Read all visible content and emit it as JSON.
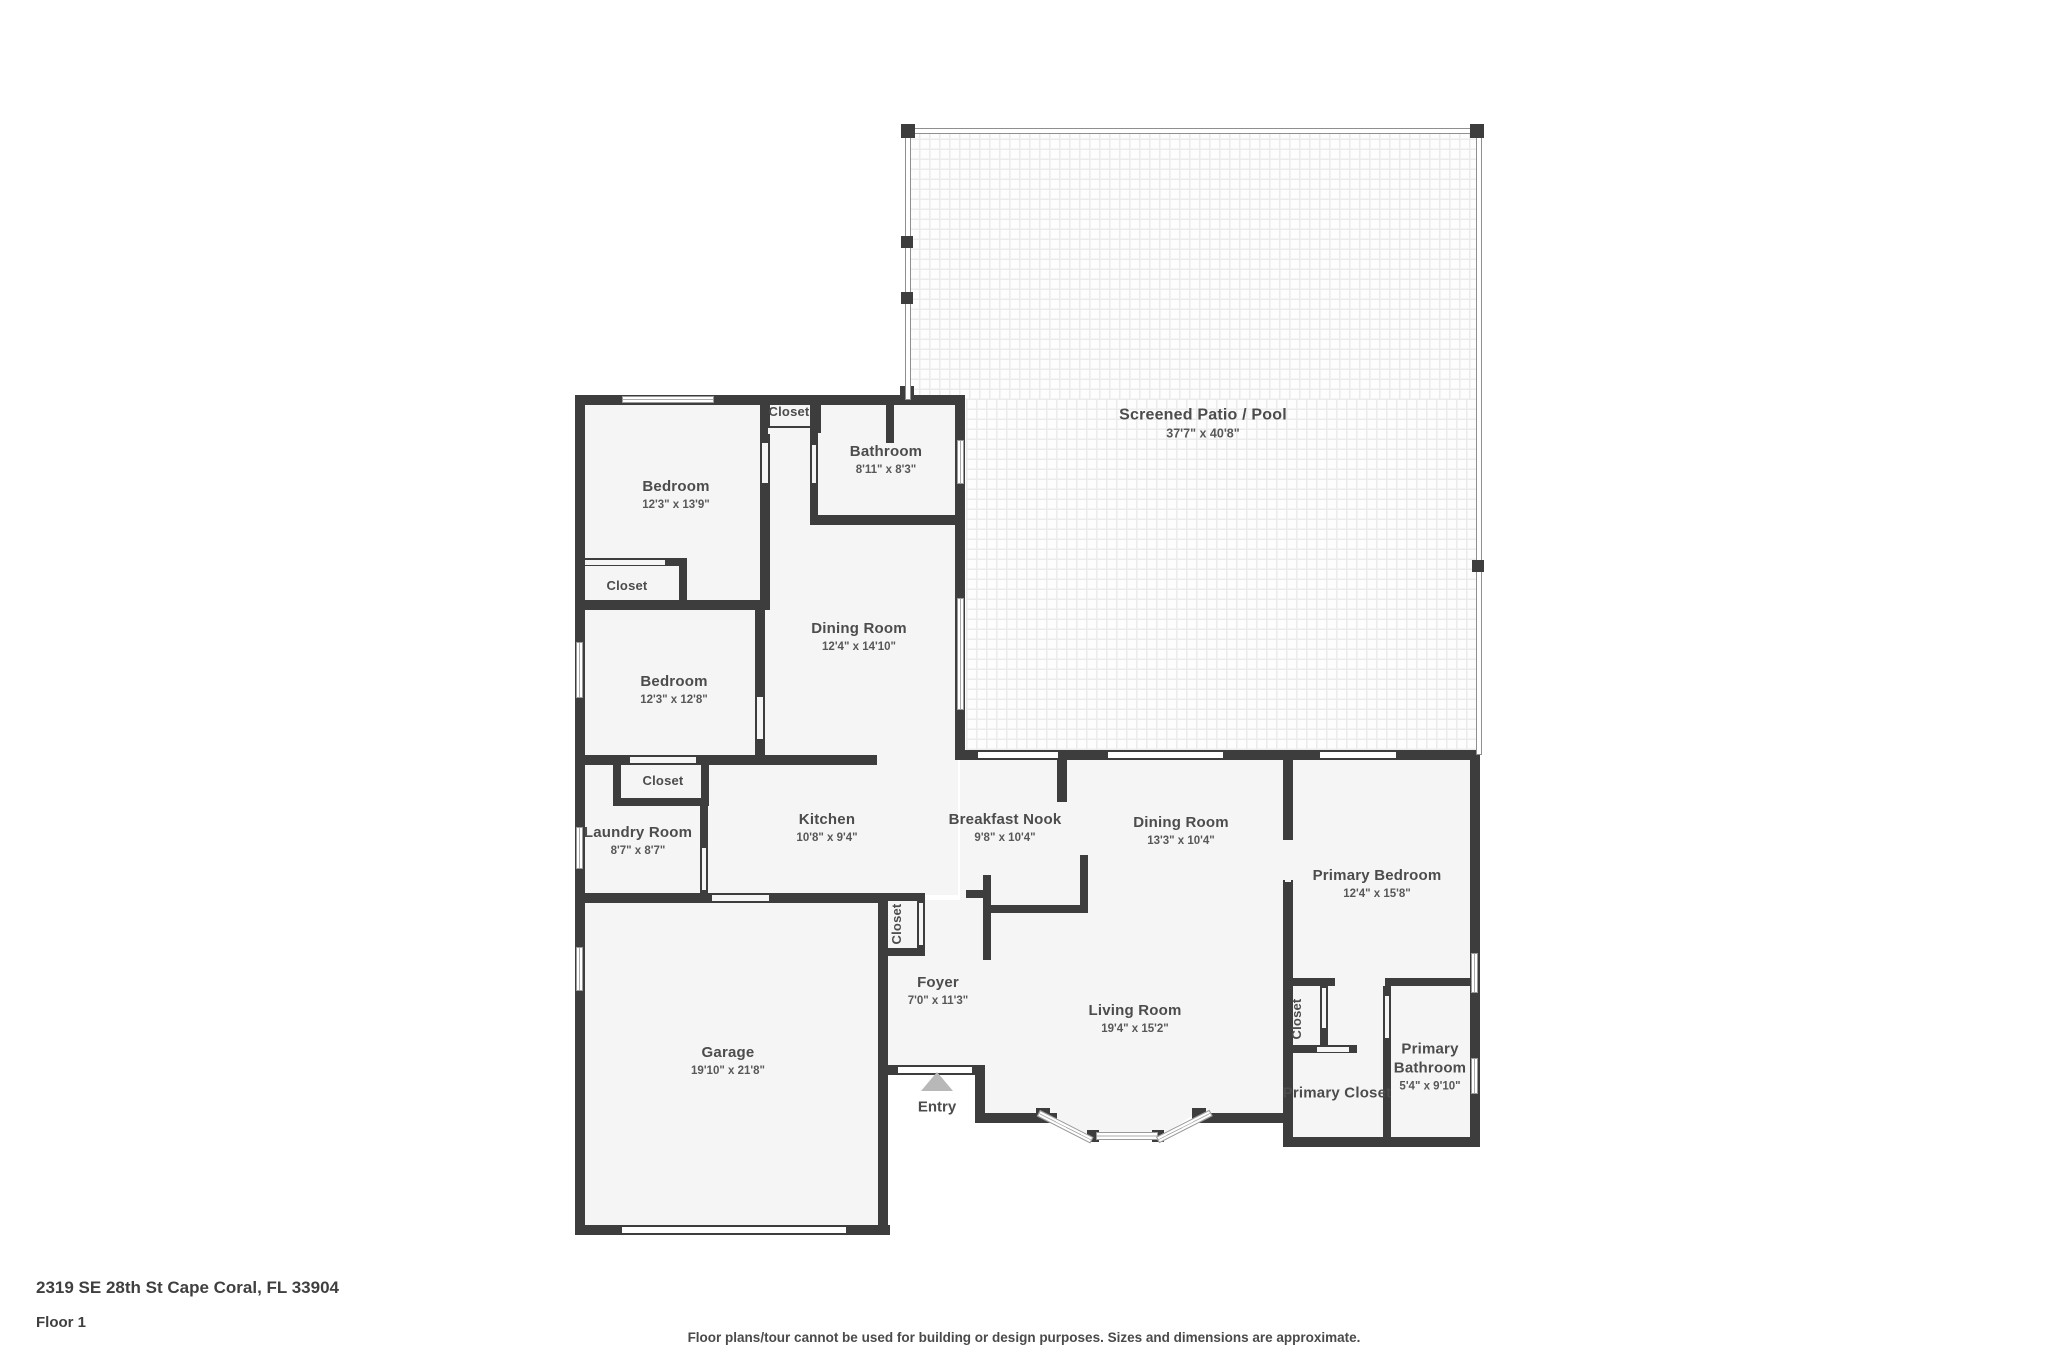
{
  "footer": {
    "address": "2319 SE 28th St Cape Coral, FL 33904",
    "floor": "Floor 1",
    "disclaimer": "Floor plans/tour cannot be used for building or design purposes. Sizes and dimensions are approximate."
  },
  "plan": {
    "rooms": [
      {
        "id": "screened-patio-pool",
        "label": "Screened Patio / Pool",
        "dims": "37'7\" x 40'8\"",
        "cx": 1203,
        "cy": 424,
        "cls": "lg"
      },
      {
        "id": "bedroom-1",
        "label": "Bedroom",
        "dims": "12'3\" x 13'9\"",
        "cx": 676,
        "cy": 495
      },
      {
        "id": "closet-hall",
        "label": "Closet",
        "cx": 789,
        "cy": 412,
        "cls": "sm"
      },
      {
        "id": "bathroom",
        "label": "Bathroom",
        "dims": "8'11\" x 8'3\"",
        "cx": 886,
        "cy": 460
      },
      {
        "id": "closet-bedroom-1",
        "label": "Closet",
        "cx": 627,
        "cy": 586,
        "cls": "sm"
      },
      {
        "id": "bedroom-2",
        "label": "Bedroom",
        "dims": "12'3\" x 12'8\"",
        "cx": 674,
        "cy": 690
      },
      {
        "id": "dining-room-1",
        "label": "Dining Room",
        "dims": "12'4\" x 14'10\"",
        "cx": 859,
        "cy": 637
      },
      {
        "id": "closet-laundry",
        "label": "Closet",
        "cx": 663,
        "cy": 781,
        "cls": "sm"
      },
      {
        "id": "laundry-room",
        "label": "Laundry Room",
        "dims": "8'7\" x 8'7\"",
        "cx": 638,
        "cy": 841
      },
      {
        "id": "kitchen",
        "label": "Kitchen",
        "dims": "10'8\" x 9'4\"",
        "cx": 827,
        "cy": 828
      },
      {
        "id": "breakfast-nook",
        "label": "Breakfast Nook",
        "dims": "9'8\" x 10'4\"",
        "cx": 1005,
        "cy": 828
      },
      {
        "id": "dining-room-2",
        "label": "Dining Room",
        "dims": "13'3\" x 10'4\"",
        "cx": 1181,
        "cy": 831
      },
      {
        "id": "primary-bedroom",
        "label": "Primary Bedroom",
        "dims": "12'4\" x 15'8\"",
        "cx": 1377,
        "cy": 884
      },
      {
        "id": "closet-foyer",
        "label": "Closet",
        "cx": 897,
        "cy": 924,
        "cls": "sm",
        "rot": true
      },
      {
        "id": "foyer",
        "label": "Foyer",
        "dims": "7'0\" x 11'3\"",
        "cx": 938,
        "cy": 991
      },
      {
        "id": "living-room",
        "label": "Living Room",
        "dims": "19'4\" x 15'2\"",
        "cx": 1135,
        "cy": 1019
      },
      {
        "id": "garage",
        "label": "Garage",
        "dims": "19'10\" x 21'8\"",
        "cx": 728,
        "cy": 1061
      },
      {
        "id": "closet-primary-hall",
        "label": "Closet",
        "cx": 1297,
        "cy": 1019,
        "cls": "sm",
        "rot": true
      },
      {
        "id": "primary-closet",
        "label": "Primary Closet",
        "cx": 1337,
        "cy": 1094
      },
      {
        "id": "primary-bathroom",
        "label": "Primary Bathroom",
        "dims": "5'4\" x 9'10\"",
        "cx": 1430,
        "cy": 1067,
        "cls": "wrap"
      }
    ],
    "entry": {
      "label": "Entry",
      "cx": 937,
      "cy": 1107,
      "tri_x": 921,
      "tri_y": 1072
    },
    "patio_fills": [
      [
        909,
        134,
        567,
        266
      ],
      [
        966,
        400,
        510,
        350
      ]
    ],
    "fills": [
      [
        580,
        400,
        378,
        495
      ],
      [
        960,
        755,
        520,
        150
      ],
      [
        580,
        900,
        300,
        327
      ],
      [
        885,
        900,
        98,
        168
      ],
      [
        975,
        900,
        315,
        215
      ],
      [
        1288,
        755,
        184,
        384
      ]
    ],
    "bay": [
      1040,
      1106,
      166,
      34
    ],
    "walls": [
      [
        575,
        395,
        390,
        10
      ],
      [
        575,
        395,
        10,
        840
      ],
      [
        575,
        1225,
        315,
        10
      ],
      [
        878,
        893,
        10,
        342
      ],
      [
        885,
        1065,
        100,
        10
      ],
      [
        975,
        1065,
        10,
        55
      ],
      [
        975,
        1113,
        82,
        10
      ],
      [
        1196,
        1113,
        97,
        10
      ],
      [
        1288,
        1137,
        190,
        10
      ],
      [
        1470,
        750,
        10,
        397
      ],
      [
        955,
        750,
        525,
        10
      ],
      [
        955,
        395,
        10,
        360
      ],
      [
        760,
        395,
        10,
        215
      ],
      [
        575,
        600,
        195,
        10
      ],
      [
        575,
        558,
        112,
        8
      ],
      [
        679,
        558,
        8,
        50
      ],
      [
        813,
        395,
        8,
        38
      ],
      [
        760,
        426,
        58,
        8
      ],
      [
        810,
        395,
        8,
        128
      ],
      [
        886,
        395,
        8,
        48
      ],
      [
        810,
        515,
        155,
        10
      ],
      [
        755,
        605,
        10,
        160
      ],
      [
        575,
        755,
        198,
        10
      ],
      [
        765,
        755,
        112,
        10
      ],
      [
        613,
        760,
        8,
        46
      ],
      [
        701,
        760,
        8,
        46
      ],
      [
        613,
        798,
        96,
        8
      ],
      [
        700,
        806,
        8,
        95
      ],
      [
        575,
        893,
        310,
        10
      ],
      [
        880,
        893,
        45,
        8
      ],
      [
        880,
        948,
        45,
        8
      ],
      [
        917,
        893,
        8,
        63
      ],
      [
        983,
        875,
        8,
        85
      ],
      [
        988,
        905,
        95,
        8
      ],
      [
        1080,
        855,
        8,
        58
      ],
      [
        966,
        890,
        20,
        8
      ],
      [
        1057,
        750,
        10,
        52
      ],
      [
        1283,
        750,
        10,
        90
      ],
      [
        1283,
        880,
        10,
        267
      ],
      [
        1283,
        978,
        52,
        8
      ],
      [
        1385,
        978,
        88,
        8
      ],
      [
        1383,
        986,
        8,
        62
      ],
      [
        1383,
        1045,
        8,
        100
      ],
      [
        1283,
        1045,
        74,
        8
      ],
      [
        1320,
        978,
        8,
        75
      ],
      [
        900,
        386,
        14,
        14
      ],
      [
        1036,
        1108,
        14,
        12
      ],
      [
        1087,
        1130,
        12,
        12
      ],
      [
        1152,
        1130,
        12,
        12
      ],
      [
        1192,
        1108,
        14,
        12
      ]
    ],
    "openings": [
      [
        762,
        443,
        6,
        40
      ],
      [
        768,
        428,
        42,
        6
      ],
      [
        812,
        445,
        4,
        38
      ],
      [
        585,
        560,
        80,
        5
      ],
      [
        757,
        697,
        6,
        42
      ],
      [
        630,
        757,
        66,
        6
      ],
      [
        702,
        848,
        4,
        42
      ],
      [
        712,
        895,
        57,
        6
      ],
      [
        919,
        903,
        4,
        42
      ],
      [
        898,
        1067,
        74,
        6,
        "w"
      ],
      [
        978,
        752,
        80,
        6,
        "w"
      ],
      [
        1108,
        752,
        115,
        6,
        "w"
      ],
      [
        1320,
        752,
        76,
        6,
        "w"
      ],
      [
        1285,
        840,
        6,
        42
      ],
      [
        1385,
        996,
        4,
        42
      ],
      [
        1322,
        988,
        4,
        40
      ],
      [
        1317,
        1047,
        32,
        5
      ],
      [
        622,
        1227,
        224,
        6,
        "w"
      ]
    ],
    "windows": [
      [
        622,
        396,
        92,
        7
      ],
      [
        576,
        642,
        7,
        56
      ],
      [
        576,
        827,
        7,
        42
      ],
      [
        576,
        947,
        7,
        44
      ],
      [
        957,
        440,
        7,
        44
      ],
      [
        957,
        598,
        7,
        112
      ],
      [
        1096,
        1132,
        62,
        8
      ],
      [
        1471,
        1058,
        7,
        36
      ],
      [
        1471,
        953,
        7,
        40
      ]
    ],
    "angled_windows": [
      {
        "x": 1040,
        "y": 1110,
        "len": 60,
        "h": 7,
        "deg": 27
      },
      {
        "x": 1156,
        "y": 1137,
        "len": 60,
        "h": 7,
        "deg": -27
      }
    ],
    "screen_walls": [
      [
        905,
        128,
        577,
        6
      ],
      [
        905,
        128,
        6,
        272
      ],
      [
        1476,
        128,
        6,
        627
      ]
    ],
    "posts": [
      [
        901,
        124,
        14,
        14
      ],
      [
        1470,
        124,
        14,
        14
      ],
      [
        901,
        236,
        12,
        12
      ],
      [
        901,
        292,
        12,
        12
      ],
      [
        1472,
        560,
        12,
        12
      ]
    ],
    "colors": {
      "wall": "#3d3d3d",
      "room_fill": "#f5f5f5",
      "text": "#4c4c4c"
    }
  }
}
